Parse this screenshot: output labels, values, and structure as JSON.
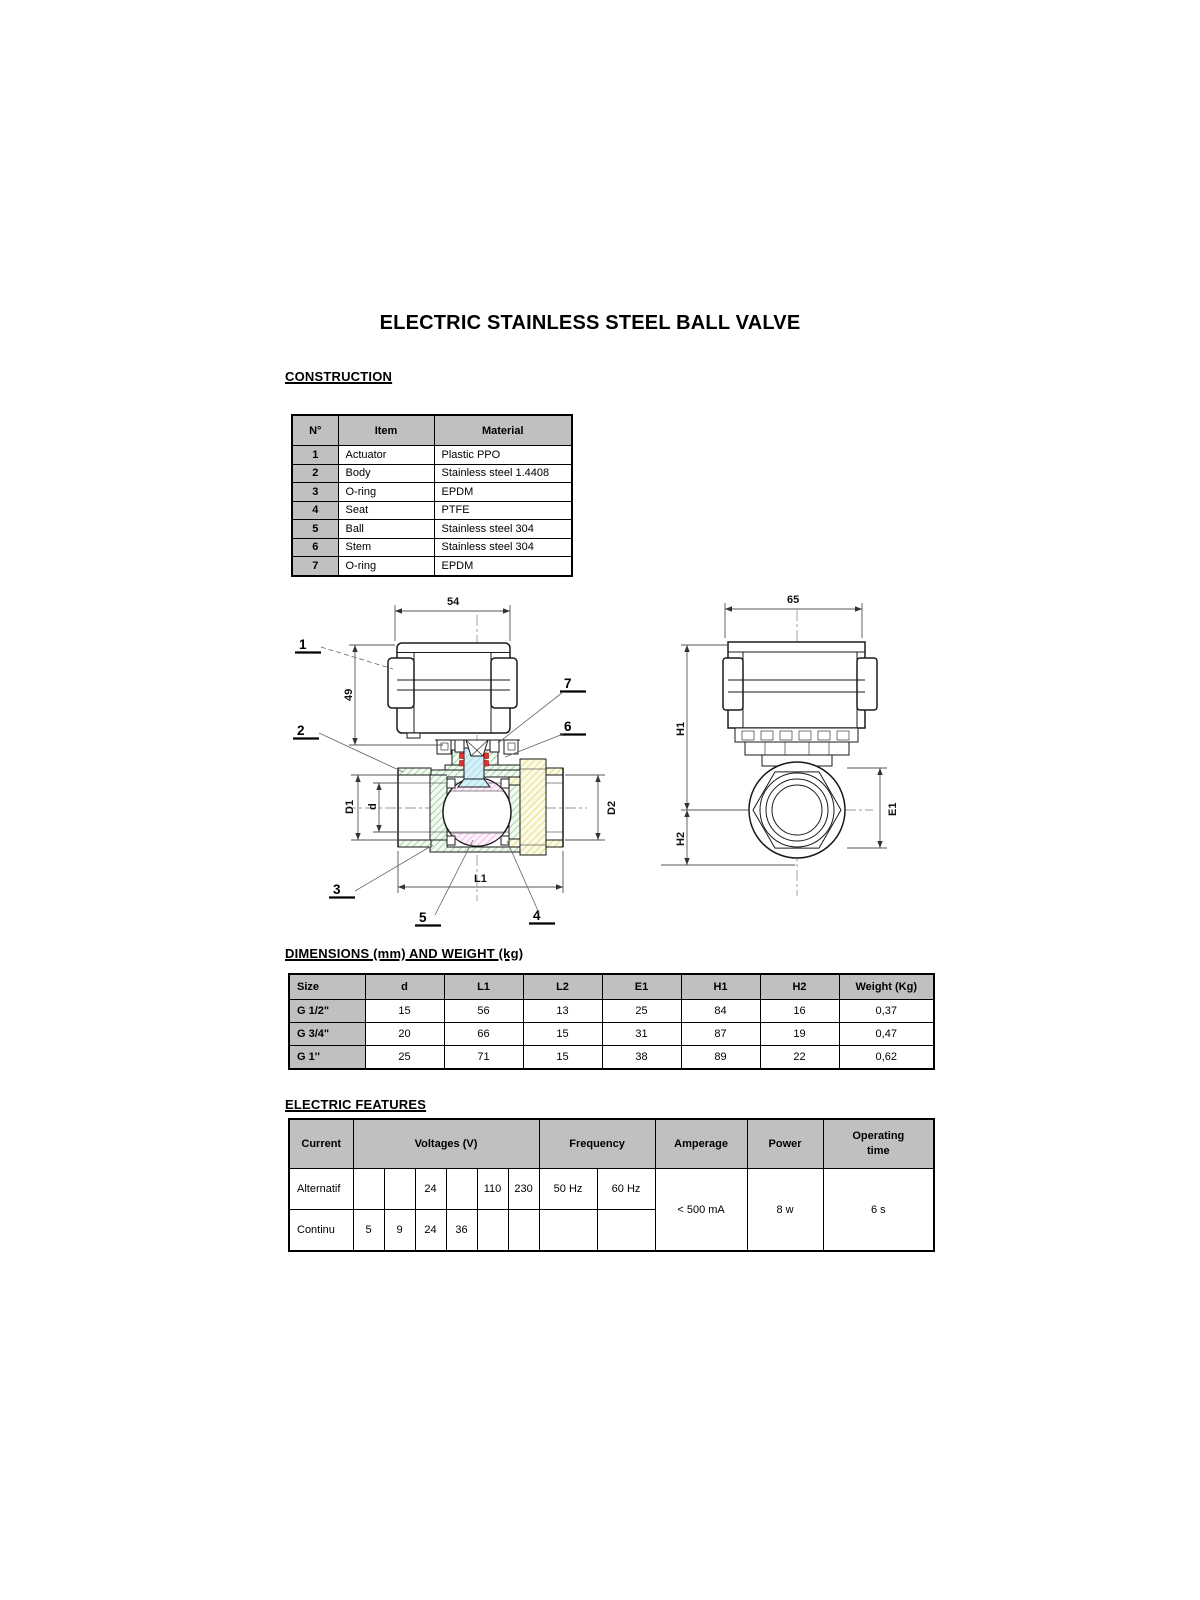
{
  "title": "ELECTRIC STAINLESS STEEL BALL VALVE",
  "construction": {
    "heading": "CONSTRUCTION",
    "headers": {
      "n": "N°",
      "item": "Item",
      "material": "Material"
    },
    "rows": [
      {
        "n": "1",
        "item": "Actuator",
        "material": "Plastic PPO"
      },
      {
        "n": "2",
        "item": "Body",
        "material": "Stainless steel 1.4408"
      },
      {
        "n": "3",
        "item": "O-ring",
        "material": "EPDM"
      },
      {
        "n": "4",
        "item": "Seat",
        "material": "PTFE"
      },
      {
        "n": "5",
        "item": "Ball",
        "material": "Stainless steel 304"
      },
      {
        "n": "6",
        "item": "Stem",
        "material": "Stainless steel 304"
      },
      {
        "n": "7",
        "item": "O-ring",
        "material": "EPDM"
      }
    ]
  },
  "dimensions": {
    "heading": "DIMENSIONS (mm) AND WEIGHT (kg)",
    "headers": [
      "Size",
      "d",
      "L1",
      "L2",
      "E1",
      "H1",
      "H2",
      "Weight (Kg)"
    ],
    "rows": [
      [
        "G 1/2\"",
        "15",
        "56",
        "13",
        "25",
        "84",
        "16",
        "0,37"
      ],
      [
        "G 3/4\"",
        "20",
        "66",
        "15",
        "31",
        "87",
        "19",
        "0,47"
      ],
      [
        "G 1''",
        "25",
        "71",
        "15",
        "38",
        "89",
        "22",
        "0,62"
      ]
    ]
  },
  "electric": {
    "heading": "ELECTRIC FEATURES",
    "headers": {
      "current": "Current",
      "voltages": "Voltages (V)",
      "frequency": "Frequency",
      "amperage": "Amperage",
      "power": "Power",
      "operating": "Operating time"
    },
    "alternatif": {
      "label": "Alternatif",
      "voltages": [
        "",
        "",
        "24",
        "",
        "110",
        "230"
      ],
      "frequencies": [
        "50 Hz",
        "60 Hz"
      ]
    },
    "continu": {
      "label": "Continu",
      "voltages": [
        "5",
        "9",
        "24",
        "36",
        "",
        ""
      ],
      "frequencies": [
        "",
        ""
      ]
    },
    "merged": {
      "amperage": "< 500 mA",
      "power": "8 w",
      "operating": "6 s"
    }
  },
  "drawing_left": {
    "dim_top": "54",
    "dim_side": "49",
    "dim_d1": "D1",
    "dim_d": "d",
    "dim_d2": "D2",
    "dim_l1": "L1",
    "labels": [
      "1",
      "2",
      "3",
      "4",
      "5",
      "6",
      "7"
    ]
  },
  "drawing_right": {
    "dim_top": "65",
    "dim_h1": "H1",
    "dim_h2": "H2",
    "dim_e1": "E1"
  },
  "colors": {
    "header_bg": "#c0c0c0",
    "border": "#000000",
    "hatch_green": "#8fc98f",
    "hatch_yellow": "#ddd45f",
    "hatch_pink": "#eda4e0",
    "stem_cyan": "#d6f0f7",
    "hatch_cyan": "#8ed2e4",
    "oring_red": "#e03232",
    "line": "#1a1a1a",
    "dim_line": "#555555"
  }
}
